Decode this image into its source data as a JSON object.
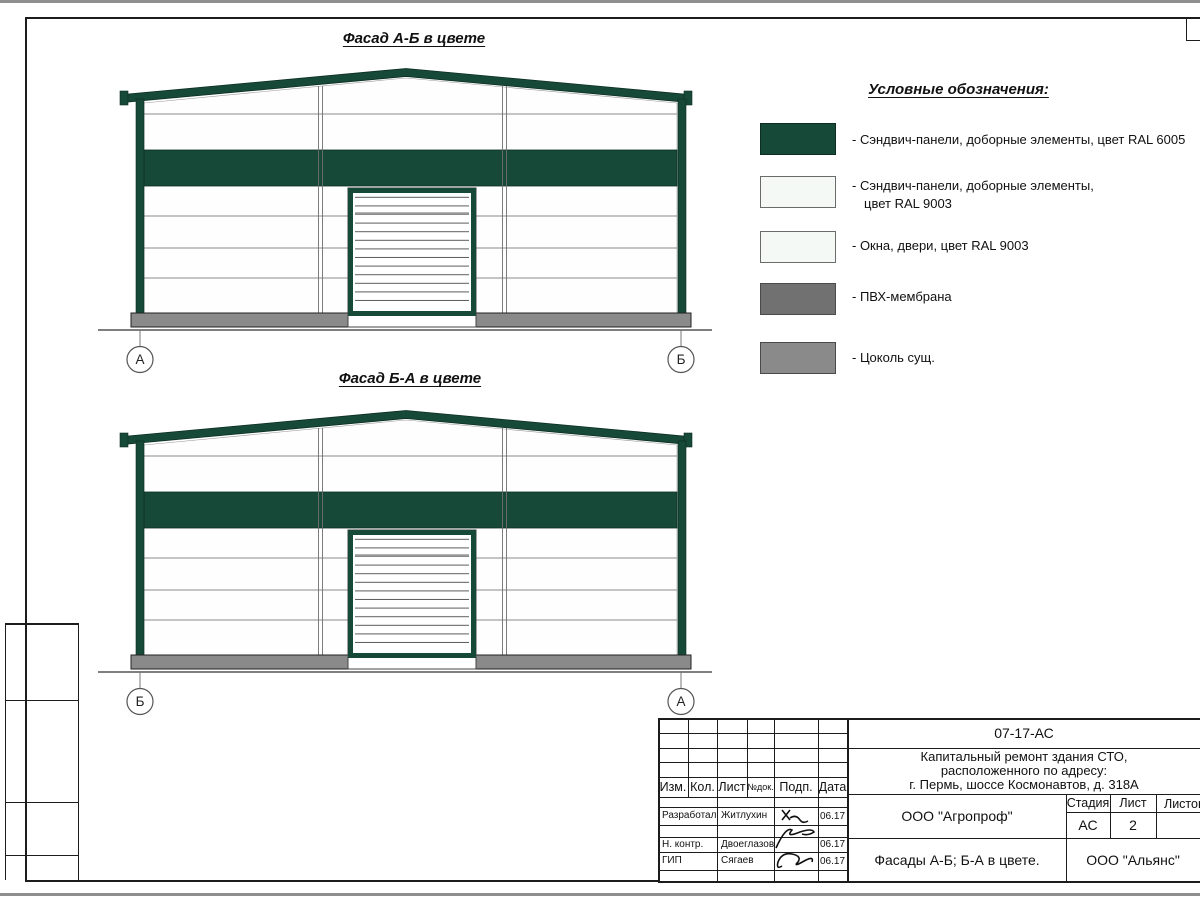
{
  "facades": [
    {
      "title": "Фасад А-Б в цвете",
      "marker_left": "А",
      "marker_right": "Б"
    },
    {
      "title": "Фасад Б-А в цвете",
      "marker_left": "Б",
      "marker_right": "А"
    }
  ],
  "legend": {
    "title": "Условные обозначения:",
    "items": [
      {
        "color": "#174938",
        "label": "- Сэндвич-панели, доборные элементы,  цвет RAL 6005"
      },
      {
        "color": "#f4f9f5",
        "label": "- Сэндвич-панели, доборные элементы,",
        "label2": "цвет RAL 9003"
      },
      {
        "color": "#f4f9f5",
        "label": "- Окна, двери, цвет RAL 9003"
      },
      {
        "color": "#717171",
        "label": "- ПВХ-мембрана"
      },
      {
        "color": "#8a8a8a",
        "label": "- Цоколь сущ."
      }
    ]
  },
  "titleblock": {
    "doc_code": "07-17-АС",
    "project_line1": "Капитальный ремонт здания СТО,",
    "project_line2": "расположенного по адресу:",
    "project_line3": "г. Пермь, шоссе Космонавтов, д. 318А",
    "org": "ООО \"Агропроф\"",
    "stage_label": "Стадия",
    "sheet_label": "Лист",
    "sheets_label": "Листов",
    "stage": "АС",
    "sheet_no": "2",
    "drawing_title": "Фасады А-Б; Б-А в цвете.",
    "contractor": "ООО \"Альянс\"",
    "cols": {
      "izm": "Изм.",
      "kol": "Кол.",
      "list": "Лист",
      "ndok": "№док.",
      "podp": "Подп.",
      "data": "Дата"
    },
    "rows": [
      {
        "role": "Разработал",
        "name": "Житлухин",
        "date": "06.17"
      },
      {
        "role": "Н. контр.",
        "name": "Двоеглазов",
        "date": "06.17"
      },
      {
        "role": "ГИП",
        "name": "Сягаев",
        "date": "06.17"
      }
    ]
  },
  "colors": {
    "ral6005_green": "#174938",
    "ral9003_white": "#f4f9f5",
    "pvc_membrane_gray": "#717171",
    "plinth_gray": "#8a8a8a"
  }
}
